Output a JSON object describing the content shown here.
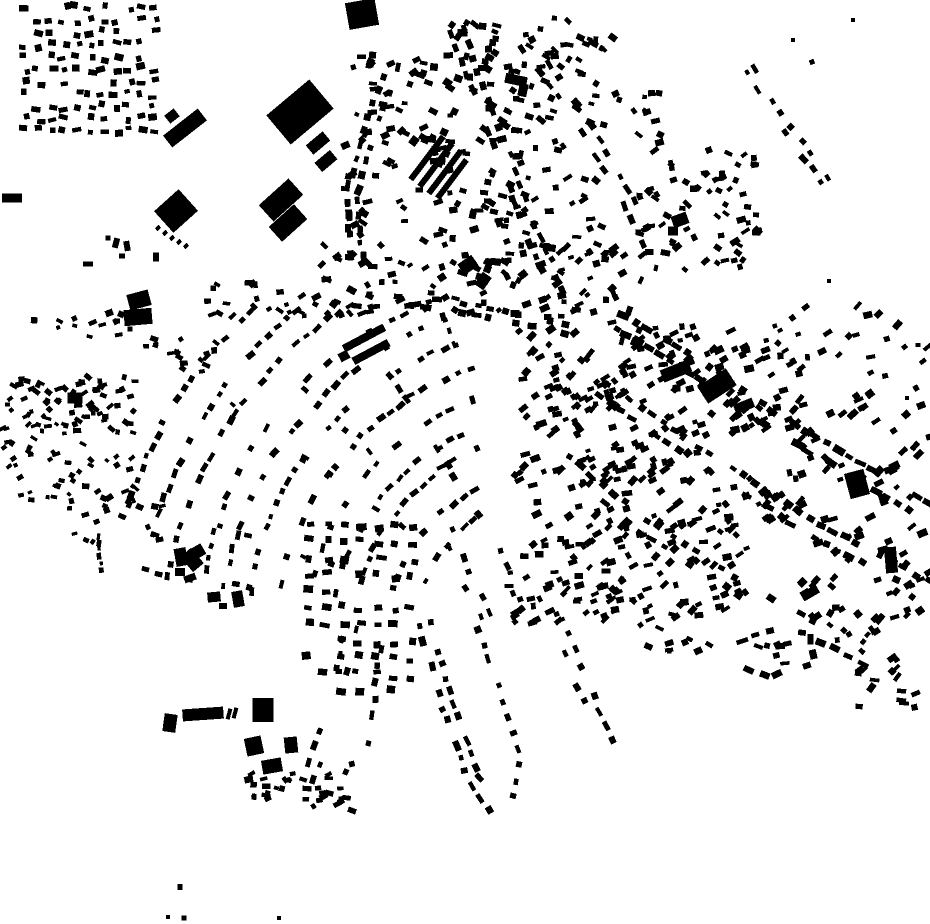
{
  "map": {
    "background": "#ffffff",
    "building_color": "#000000",
    "width": 930,
    "height": 924,
    "seed": 7,
    "buildings": [
      [
        362,
        14,
        30,
        27,
        -10
      ],
      [
        300,
        112,
        56,
        38,
        -40
      ],
      [
        318,
        143,
        22,
        12,
        -40
      ],
      [
        326,
        161,
        20,
        12,
        -40
      ],
      [
        185,
        128,
        44,
        15,
        -38
      ],
      [
        172,
        116,
        12,
        10,
        -38
      ],
      [
        176,
        211,
        33,
        29,
        -42
      ],
      [
        158,
        228,
        5,
        4,
        -42
      ],
      [
        165,
        233,
        5,
        4,
        -42
      ],
      [
        172,
        238,
        5,
        4,
        -42
      ],
      [
        179,
        242,
        5,
        4,
        -42
      ],
      [
        186,
        246,
        5,
        4,
        -42
      ],
      [
        281,
        200,
        40,
        22,
        -42
      ],
      [
        288,
        223,
        34,
        20,
        -42
      ],
      [
        12,
        198,
        20,
        9,
        0
      ],
      [
        139,
        300,
        22,
        16,
        -15
      ],
      [
        138,
        317,
        28,
        16,
        -5
      ],
      [
        75,
        398,
        15,
        11,
        0
      ],
      [
        364,
        338,
        46,
        8,
        -28
      ],
      [
        371,
        352,
        40,
        8,
        -28
      ],
      [
        344,
        356,
        10,
        9,
        -28
      ],
      [
        427,
        158,
        54,
        6,
        -53
      ],
      [
        436,
        165,
        54,
        6,
        -53
      ],
      [
        445,
        172,
        54,
        6,
        -53
      ],
      [
        452,
        179,
        48,
        6,
        -53
      ],
      [
        414,
        141,
        9,
        8,
        -53
      ],
      [
        516,
        80,
        22,
        10,
        12
      ],
      [
        523,
        90,
        9,
        13,
        12
      ],
      [
        468,
        265,
        17,
        13,
        -35
      ],
      [
        483,
        281,
        15,
        11,
        -55
      ],
      [
        676,
        371,
        30,
        13,
        -22
      ],
      [
        717,
        386,
        34,
        20,
        -33
      ],
      [
        744,
        406,
        20,
        10,
        -22
      ],
      [
        857,
        484,
        20,
        26,
        -15
      ],
      [
        891,
        560,
        12,
        26,
        -5
      ],
      [
        810,
        593,
        18,
        9,
        -30
      ],
      [
        181,
        557,
        12,
        18,
        -10
      ],
      [
        192,
        560,
        14,
        20,
        -40
      ],
      [
        180,
        572,
        10,
        8,
        0
      ],
      [
        190,
        578,
        12,
        7,
        -20
      ],
      [
        199,
        551,
        10,
        12,
        -30
      ],
      [
        214,
        597,
        13,
        10,
        -5
      ],
      [
        238,
        599,
        11,
        16,
        -10
      ],
      [
        223,
        606,
        8,
        6,
        0
      ],
      [
        170,
        723,
        13,
        18,
        8
      ],
      [
        203,
        714,
        41,
        12,
        -4
      ],
      [
        229,
        714,
        4,
        11,
        15
      ],
      [
        235,
        713,
        4,
        11,
        15
      ],
      [
        263,
        710,
        21,
        24,
        0
      ],
      [
        254,
        746,
        17,
        18,
        -12
      ],
      [
        272,
        766,
        20,
        14,
        -10
      ],
      [
        291,
        745,
        13,
        16,
        -6
      ],
      [
        680,
        220,
        16,
        12,
        -20
      ],
      [
        673,
        231,
        10,
        9,
        0
      ],
      [
        116,
        243,
        6,
        10,
        15
      ],
      [
        127,
        246,
        6,
        10,
        -10
      ],
      [
        156,
        257,
        6,
        9,
        0
      ],
      [
        88,
        264,
        10,
        5,
        0
      ],
      [
        122,
        256,
        6,
        5,
        0
      ],
      [
        108,
        238,
        5,
        5,
        0
      ],
      [
        180,
        887,
        5,
        6,
        0
      ],
      [
        184,
        918,
        5,
        5,
        0
      ],
      [
        168,
        917,
        4,
        4,
        0
      ],
      [
        279,
        918,
        4,
        4,
        0
      ],
      [
        853,
        20,
        4,
        4,
        0
      ],
      [
        812,
        62,
        5,
        5,
        -20
      ],
      [
        793,
        40,
        4,
        4,
        0
      ],
      [
        829,
        281,
        4,
        4,
        0
      ],
      [
        907,
        398,
        4,
        4,
        0
      ],
      [
        918,
        345,
        5,
        4,
        0
      ]
    ],
    "grids": [
      {
        "x": 25,
        "y": 8,
        "cols": 11,
        "rows": 11,
        "dx": 13,
        "dy": 12.3,
        "bw": 7,
        "bh": 5.5,
        "angle": 0,
        "rot_jitter": 16,
        "jitter": 3.5,
        "density": 0.82
      },
      {
        "x": 312,
        "y": 524,
        "cols": 7,
        "rows": 11,
        "dx": 17,
        "dy": 16.5,
        "bw": 8,
        "bh": 6,
        "angle": 2,
        "rot_jitter": 10,
        "jitter": 3,
        "density": 0.8
      }
    ],
    "scatters": [
      {
        "x": 345,
        "y": 55,
        "w": 80,
        "h": 180,
        "n": 50,
        "bw": 7,
        "bh": 5,
        "angle": 0,
        "spread": 45
      },
      {
        "x": 420,
        "y": 22,
        "w": 100,
        "h": 118,
        "n": 45,
        "bw": 7.5,
        "bh": 5.5,
        "angle": 20,
        "spread": 25
      },
      {
        "x": 428,
        "y": 138,
        "w": 90,
        "h": 100,
        "n": 45,
        "bw": 7,
        "bh": 5,
        "angle": 10,
        "spread": 30
      },
      {
        "x": 495,
        "y": 28,
        "w": 112,
        "h": 107,
        "n": 40,
        "bw": 7,
        "bh": 5,
        "angle": 15,
        "spread": 25
      },
      {
        "x": 515,
        "y": 130,
        "w": 95,
        "h": 115,
        "n": 28,
        "bw": 7,
        "bh": 5,
        "angle": 0,
        "spread": 40
      },
      {
        "x": 312,
        "y": 238,
        "w": 122,
        "h": 78,
        "n": 38,
        "bw": 7,
        "bh": 5,
        "angle": 0,
        "spread": 45
      },
      {
        "x": 420,
        "y": 235,
        "w": 142,
        "h": 82,
        "n": 55,
        "bw": 7.5,
        "bh": 5.5,
        "angle": 0,
        "spread": 40
      },
      {
        "x": 550,
        "y": 15,
        "w": 78,
        "h": 48,
        "n": 10,
        "bw": 6.5,
        "bh": 5,
        "angle": 20,
        "spread": 30
      },
      {
        "x": 638,
        "y": 148,
        "w": 122,
        "h": 122,
        "n": 75,
        "bw": 7,
        "bh": 5,
        "angle": 0,
        "spread": 45
      },
      {
        "x": 612,
        "y": 92,
        "w": 52,
        "h": 60,
        "n": 12,
        "bw": 6.5,
        "bh": 5,
        "angle": 0,
        "spread": 40
      },
      {
        "x": 18,
        "y": 375,
        "w": 120,
        "h": 126,
        "n": 110,
        "bw": 6,
        "bh": 4.5,
        "angle": 0,
        "spread": 45
      },
      {
        "x": 2,
        "y": 380,
        "w": 22,
        "h": 90,
        "n": 12,
        "bw": 6,
        "bh": 4.5,
        "angle": 0,
        "spread": 40
      },
      {
        "x": 60,
        "y": 498,
        "w": 105,
        "h": 45,
        "n": 18,
        "bw": 6,
        "bh": 4.5,
        "angle": 0,
        "spread": 40
      },
      {
        "x": 515,
        "y": 325,
        "w": 288,
        "h": 212,
        "n": 220,
        "bw": 7.5,
        "bh": 5.5,
        "angle": -28,
        "spread": 24
      },
      {
        "x": 548,
        "y": 360,
        "w": 105,
        "h": 125,
        "n": 60,
        "bw": 7,
        "bh": 5,
        "angle": -30,
        "spread": 20
      },
      {
        "x": 508,
        "y": 538,
        "w": 120,
        "h": 86,
        "n": 65,
        "bw": 7,
        "bh": 5,
        "angle": -22,
        "spread": 25
      },
      {
        "x": 620,
        "y": 522,
        "w": 128,
        "h": 98,
        "n": 55,
        "bw": 7,
        "bh": 5,
        "angle": -28,
        "spread": 25
      },
      {
        "x": 800,
        "y": 388,
        "w": 130,
        "h": 245,
        "n": 85,
        "bw": 8,
        "bh": 5.5,
        "angle": -33,
        "spread": 18
      },
      {
        "x": 768,
        "y": 295,
        "w": 162,
        "h": 82,
        "n": 28,
        "bw": 7,
        "bh": 5,
        "angle": -25,
        "spread": 25
      },
      {
        "x": 205,
        "y": 282,
        "w": 110,
        "h": 34,
        "n": 20,
        "bw": 6,
        "bh": 5,
        "angle": 0,
        "spread": 45
      },
      {
        "x": 240,
        "y": 758,
        "w": 112,
        "h": 56,
        "n": 26,
        "bw": 6.5,
        "bh": 5,
        "angle": -5,
        "spread": 35
      },
      {
        "x": 855,
        "y": 650,
        "w": 62,
        "h": 58,
        "n": 16,
        "bw": 7,
        "bh": 5,
        "angle": -20,
        "spread": 35
      },
      {
        "x": 640,
        "y": 610,
        "w": 70,
        "h": 42,
        "n": 13,
        "bw": 6.5,
        "bh": 5,
        "angle": 0,
        "spread": 40
      },
      {
        "x": 750,
        "y": 640,
        "w": 52,
        "h": 30,
        "n": 7,
        "bw": 7,
        "bh": 5,
        "angle": -10,
        "spread": 30
      },
      {
        "x": 828,
        "y": 604,
        "w": 64,
        "h": 48,
        "n": 10,
        "bw": 6.5,
        "bh": 5,
        "angle": -30,
        "spread": 30
      },
      {
        "x": 20,
        "y": 312,
        "w": 110,
        "h": 26,
        "n": 14,
        "bw": 6,
        "bh": 5,
        "angle": 0,
        "spread": 30
      },
      {
        "x": 138,
        "y": 330,
        "w": 80,
        "h": 52,
        "n": 16,
        "bw": 6,
        "bh": 5,
        "angle": 0,
        "spread": 40
      },
      {
        "x": 560,
        "y": 240,
        "w": 65,
        "h": 85,
        "n": 30,
        "bw": 7,
        "bh": 5,
        "angle": -20,
        "spread": 30
      }
    ],
    "streets": [
      {
        "pts": [
          [
            455,
            25
          ],
          [
            480,
            95
          ],
          [
            508,
            165
          ],
          [
            532,
            235
          ],
          [
            560,
            300
          ]
        ],
        "step": 13,
        "bw": 8,
        "bh": 5.5,
        "offsets": [
          -6,
          6
        ],
        "density": 0.8
      },
      {
        "pts": [
          [
            396,
            58
          ],
          [
            372,
            125
          ],
          [
            352,
            195
          ],
          [
            358,
            262
          ]
        ],
        "step": 13,
        "bw": 7.5,
        "bh": 5.5,
        "offsets": [
          -5,
          6
        ],
        "density": 0.7
      },
      {
        "pts": [
          [
            522,
            38
          ],
          [
            576,
            112
          ],
          [
            620,
            185
          ],
          [
            652,
            248
          ]
        ],
        "step": 14,
        "bw": 7.5,
        "bh": 5.5,
        "offsets": [
          -6,
          6
        ],
        "density": 0.6
      },
      {
        "pts": [
          [
            350,
            300
          ],
          [
            430,
            302
          ],
          [
            510,
            318
          ],
          [
            572,
            330
          ]
        ],
        "step": 13,
        "bw": 7.5,
        "bh": 5.5,
        "offsets": [
          -5,
          5
        ],
        "density": 0.65
      },
      {
        "pts": [
          [
            615,
            320
          ],
          [
            700,
            370
          ],
          [
            795,
            435
          ],
          [
            930,
            512
          ]
        ],
        "step": 12,
        "bw": 9,
        "bh": 6,
        "offsets": [
          -8,
          8
        ],
        "density": 0.8
      },
      {
        "pts": [
          [
            597,
            386
          ],
          [
            700,
            456
          ],
          [
            812,
            528
          ],
          [
            930,
            590
          ]
        ],
        "step": 13,
        "bw": 8,
        "bh": 5.5,
        "offsets": [
          -7,
          7
        ],
        "density": 0.7
      },
      {
        "pts": [
          [
            558,
            458
          ],
          [
            650,
            530
          ],
          [
            762,
            602
          ],
          [
            872,
            662
          ]
        ],
        "step": 14,
        "bw": 8,
        "bh": 5.5,
        "offsets": [
          -7,
          7
        ],
        "density": 0.55
      },
      {
        "pts": [
          [
            742,
            66
          ],
          [
            770,
            112
          ],
          [
            800,
            152
          ],
          [
            826,
            188
          ]
        ],
        "step": 14,
        "bw": 7,
        "bh": 5,
        "offsets": [
          -8,
          0
        ],
        "density": 0.6
      },
      {
        "pts": [
          [
            654,
            258
          ],
          [
            638,
            306
          ],
          [
            626,
            348
          ]
        ],
        "step": 13,
        "bw": 7,
        "bh": 5,
        "offsets": [
          -6,
          6
        ],
        "density": 0.5
      },
      {
        "pts": [
          [
            424,
            618
          ],
          [
            446,
            700
          ],
          [
            472,
            775
          ],
          [
            500,
            814
          ]
        ],
        "step": 13,
        "bw": 7.5,
        "bh": 5.5,
        "offsets": [
          -5,
          6
        ],
        "density": 0.7
      },
      {
        "pts": [
          [
            480,
            622
          ],
          [
            506,
            692
          ],
          [
            524,
            756
          ],
          [
            518,
            806
          ]
        ],
        "step": 14,
        "bw": 7,
        "bh": 5.5,
        "offsets": [
          5
        ],
        "density": 0.65
      },
      {
        "pts": [
          [
            560,
            628
          ],
          [
            586,
            692
          ],
          [
            612,
            748
          ]
        ],
        "step": 14,
        "bw": 7,
        "bh": 5,
        "offsets": [
          -5,
          5
        ],
        "density": 0.55
      },
      {
        "pts": [
          [
            352,
            620
          ],
          [
            337,
            692
          ],
          [
            317,
            756
          ],
          [
            299,
            802
          ]
        ],
        "step": 14,
        "bw": 7,
        "bh": 5,
        "offsets": [
          -5,
          5
        ],
        "density": 0.55
      },
      {
        "pts": [
          [
            388,
            626
          ],
          [
            380,
            692
          ],
          [
            373,
            752
          ]
        ],
        "step": 15,
        "bw": 7,
        "bh": 5,
        "offsets": [
          5
        ],
        "density": 0.5
      },
      {
        "pts": [
          [
            737,
            644
          ],
          [
            776,
            629
          ],
          [
            809,
            633
          ],
          [
            813,
            663
          ],
          [
            771,
            677
          ],
          [
            741,
            667
          ]
        ],
        "step": 12,
        "bw": 9,
        "bh": 6,
        "offsets": [
          0
        ],
        "density": 0.85
      },
      {
        "pts": [
          [
            444,
            524
          ],
          [
            468,
            580
          ],
          [
            488,
            620
          ]
        ],
        "step": 13,
        "bw": 7,
        "bh": 5,
        "offsets": [
          -5,
          5
        ],
        "density": 0.6
      },
      {
        "pts": [
          [
            502,
            540
          ],
          [
            520,
            590
          ],
          [
            534,
            622
          ]
        ],
        "step": 14,
        "bw": 7,
        "bh": 5,
        "offsets": [
          5
        ],
        "density": 0.55
      },
      {
        "pts": [
          [
            100,
            532
          ],
          [
            100,
            575
          ]
        ],
        "step": 7,
        "bw": 5,
        "bh": 4,
        "offsets": [
          0
        ],
        "density": 1.0
      },
      {
        "pts": [
          [
            247,
            790
          ],
          [
            300,
            795
          ],
          [
            348,
            792
          ]
        ],
        "step": 12,
        "bw": 6.5,
        "bh": 5,
        "offsets": [
          -5,
          5
        ],
        "density": 0.55
      }
    ],
    "fans": [
      {
        "cx": 560,
        "cy": 640,
        "r0": 150,
        "r1": 470,
        "dr": 27,
        "a0": -171,
        "a1": -99,
        "step": 13,
        "density": 0.62,
        "bw": 7,
        "bh": 5,
        "rays": 7,
        "ray_step": 15,
        "ray_density": 0.4,
        "clip": {
          "x": 128,
          "y": 303,
          "w": 354,
          "h": 290
        }
      }
    ]
  }
}
